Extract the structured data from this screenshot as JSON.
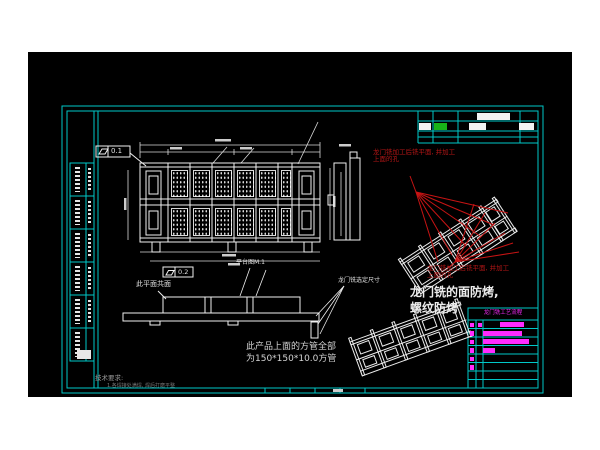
{
  "meta": {
    "description": "CAD engineering drawing sheet (gantry-milled platform weldment) on black model space",
    "canvas_bg": "#000000",
    "page_bg": "#ffffff"
  },
  "colors": {
    "sheet_frame": "#00c8c8",
    "line_art": "#f0f0f0",
    "red_annotation": "#b41616",
    "magenta": "#ff2bff",
    "green_block": "#18b418"
  },
  "notes": {
    "red_note_top_line1": "龙门铣加工后铣平面, 并加工",
    "red_note_top_line2": "上面的孔",
    "red_note_bottom_line1": "龙门铣加工后铣平面, 并加工",
    "red_note_bottom_line2": "上面的孔",
    "coplanar": "此平面共面",
    "platform_ref": "平台图M.1",
    "gantry_dim": "龙门铣选定尺寸",
    "antibake_line1": "龙门铣的面防烤,",
    "antibake_line2": "螺纹防烤",
    "tube_line1": "此产品上面的方管全部",
    "tube_line2": "为150*150*10.0方管",
    "tech_title": "技术要求:",
    "tech_item": "1.各焊接处满焊, 焊后打磨平整",
    "flatness1_value": "0.1",
    "flatness2_value": "0.2"
  },
  "process_table": {
    "title": "龙门铣工艺流程",
    "rows": [
      {
        "sq1": true,
        "sq2": true,
        "bar_x": 500,
        "bar_w": 24
      },
      {
        "sq1": true,
        "sq2": false,
        "bar_x": 483,
        "bar_w": 39
      },
      {
        "sq1": true,
        "sq2": false,
        "bar_x": 483,
        "bar_w": 46
      },
      {
        "sq1": true,
        "sq2": false,
        "bar_x": 483,
        "bar_w": 12
      },
      {
        "sq1": true,
        "sq2": false,
        "bar_x": 0,
        "bar_w": 0
      },
      {
        "sq1": true,
        "sq2": false,
        "bar_x": 0,
        "bar_w": 0
      },
      {
        "sq1": false,
        "sq2": false,
        "bar_x": 0,
        "bar_w": 0
      },
      {
        "sq1": false,
        "sq2": false,
        "bar_x": 0,
        "bar_w": 0
      }
    ]
  },
  "highlight_blocks": [
    {
      "x": 477,
      "y": 112.5,
      "w": 33,
      "h": 7,
      "color": "#f2f2f2"
    },
    {
      "x": 419,
      "y": 122.5,
      "w": 12,
      "h": 7,
      "color": "#f2f2f2"
    },
    {
      "x": 434,
      "y": 122.5,
      "w": 13,
      "h": 7,
      "color": "#18b418"
    },
    {
      "x": 469,
      "y": 122.5,
      "w": 17,
      "h": 7,
      "color": "#f2f2f2"
    },
    {
      "x": 519,
      "y": 122.5,
      "w": 15,
      "h": 7,
      "color": "#f2f2f2"
    },
    {
      "x": 77,
      "y": 350,
      "w": 14,
      "h": 9,
      "color": "#e8e8e8"
    },
    {
      "x": 333,
      "y": 389,
      "w": 10,
      "h": 2.5,
      "color": "#cccccc"
    }
  ],
  "bom_strip": {
    "cells": 6
  }
}
